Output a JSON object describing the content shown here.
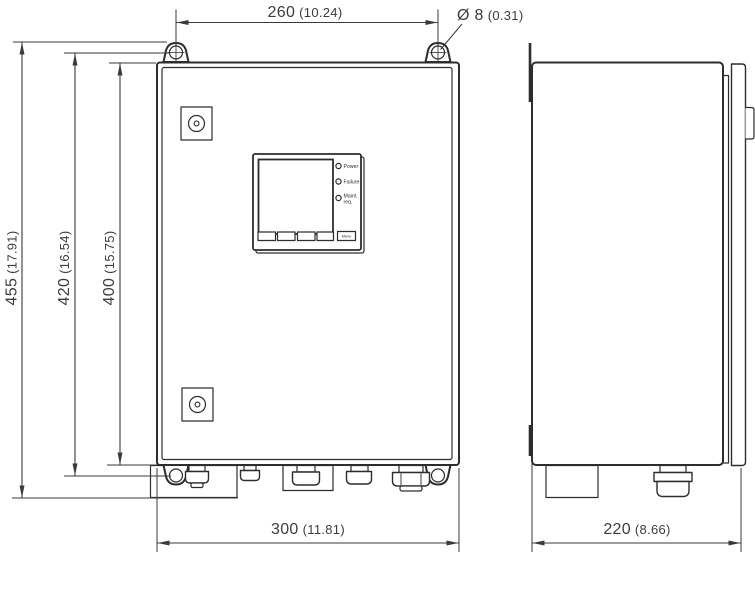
{
  "dimensions": {
    "mounting_hole_spacing_width": {
      "mm": "260",
      "inch": "(10.24)"
    },
    "mounting_hole_diameter": {
      "mm": "Ø 8",
      "inch": "(0.31)"
    },
    "overall_height": {
      "mm": "455",
      "inch": "(17.91)"
    },
    "mounting_hole_spacing_height": {
      "mm": "420",
      "inch": "(16.54)"
    },
    "housing_height": {
      "mm": "400",
      "inch": "(15.75)"
    },
    "housing_width": {
      "mm": "300",
      "inch": "(11.81)"
    },
    "housing_depth": {
      "mm": "220",
      "inch": "(8.66)"
    }
  },
  "control_panel": {
    "leds": [
      {
        "label": "Power"
      },
      {
        "label": "Failure"
      },
      {
        "label": "Maint.",
        "label_line2": "req."
      }
    ],
    "menu_button_label": "Menu"
  },
  "colors": {
    "line": "#2d2d2d",
    "dimension": "#3a3a3a",
    "background": "#ffffff"
  }
}
